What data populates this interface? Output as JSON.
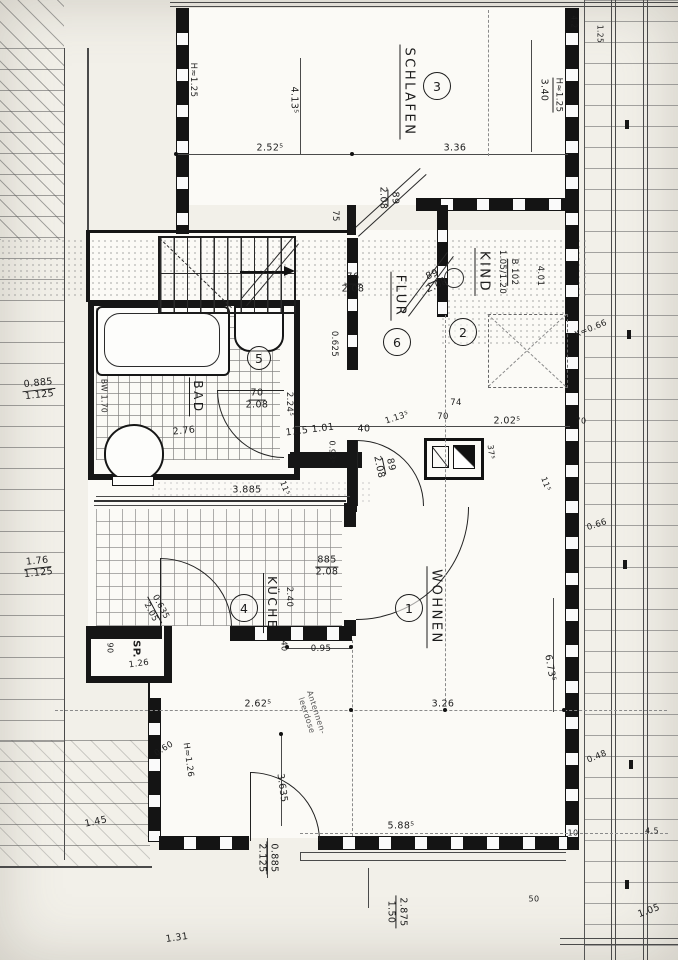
{
  "document": {
    "type": "architectural floor plan (scanned hand drawing)"
  },
  "rooms": {
    "schlafen": {
      "label": "SCHLAFEN",
      "number": "3"
    },
    "kind": {
      "label": "KIND",
      "number": "2"
    },
    "flur": {
      "label": "FLUR",
      "number": "6"
    },
    "bad": {
      "label": "BAD",
      "number": "5"
    },
    "kueche": {
      "label": "KÜCHE",
      "number": "4"
    },
    "wohnen": {
      "label": "WOHNEN",
      "number": "1"
    },
    "sp": {
      "label": "SP.",
      "height": "1.26"
    }
  },
  "dims": {
    "h125_left": "H≈1.25",
    "d4135": "4.13⁵",
    "d2525": "2.52⁵",
    "d340": "3.40",
    "h125_right": "H≈1.25",
    "d336": "3.36",
    "d75": "75",
    "d0625": "0.625",
    "d276": "2.76",
    "d2245": "2.24⁵",
    "d115_101": "11.5 1.01",
    "d40": "40",
    "d1135": "1.13⁵",
    "d0935": "0.93⁵",
    "d115a": "11⁵",
    "d74": "74",
    "d70": "70",
    "d2025": "2.02⁵",
    "d375": "37⁵",
    "d115b": "11⁵",
    "d70b": "70",
    "d401": "4.01",
    "d3885": "3.885",
    "d240": "2.40",
    "d90": "90",
    "d095": "0.95",
    "d40b": "40",
    "d2625": "2.62⁵",
    "d326": "3.26",
    "d060": "0.60",
    "h126": "H≈1.26",
    "d3635": "3.635",
    "d145": "1.45",
    "d5885": "5.88⁵",
    "d6735": "6.73⁵",
    "d10": "10",
    "d45": "4.5",
    "d50": "50",
    "d105": "1.05",
    "d131": "1.31",
    "tr1": "4.2",
    "tr2": "1.25"
  },
  "fractions": {
    "f89_208": {
      "num": "89",
      "den": "2.08"
    },
    "f76_208": {
      "num": "76",
      "den": "2.08"
    },
    "f89_208b": {
      "num": "89",
      "den": "2.08"
    },
    "f89_208c": {
      "num": "89",
      "den": "2.08"
    },
    "f70_208": {
      "num": "70",
      "den": "2.08"
    },
    "f0885_1125": {
      "num": "0.885",
      "den": "1.125"
    },
    "f885_208": {
      "num": "885",
      "den": "2.08"
    },
    "f0635_205": {
      "num": "0.635",
      "den": "2.05"
    },
    "f176_1125": {
      "num": "1.76",
      "den": "1.125"
    },
    "f0885_2125": {
      "num": "0.885",
      "den": "2.125"
    },
    "f2875_150": {
      "num": "2.875",
      "den": "1.50"
    }
  },
  "notes": {
    "kind_window1": "B 102",
    "kind_window2": "1.05/1.20",
    "bw": "BW 1.70",
    "k066": "K=0.66",
    "n066": "0.66",
    "n048": "0.48",
    "ant1": "Antennen-",
    "ant2": "leerdose",
    "sp_h": "1.26"
  }
}
